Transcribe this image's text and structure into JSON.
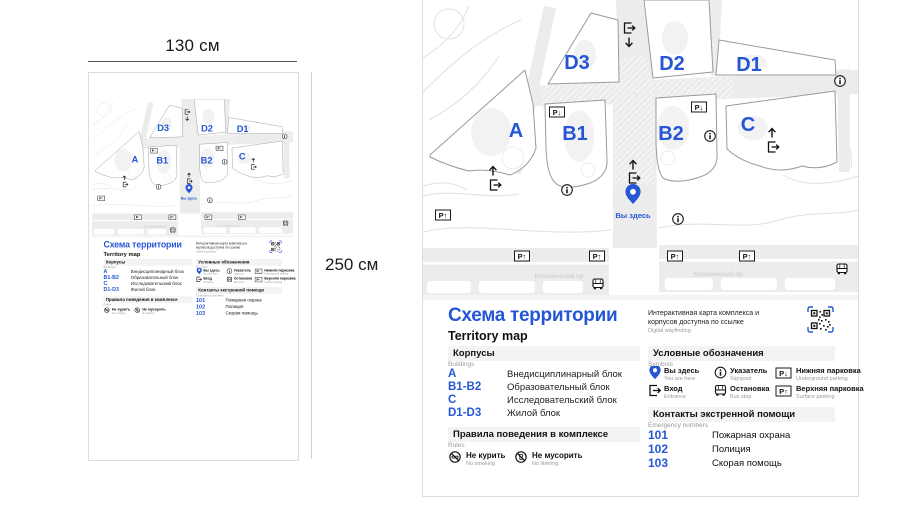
{
  "dimensions": {
    "width_label": "130 см",
    "height_label": "250 см"
  },
  "sign": {
    "title_ru": "Схема территории",
    "title_en": "Territory map",
    "qr_note_ru": "Интерактивная карта комплекса и корпусов доступна по ссылке",
    "qr_note_en": "Digital wayfinding",
    "map": {
      "buildings": {
        "a": "A",
        "b1": "B1",
        "b2": "B2",
        "c": "C",
        "d1": "D1",
        "d2": "D2",
        "d3": "D3"
      },
      "you_are_here": "Вы здесь",
      "street_name": "Коломенский пр.",
      "parking_down_label": "P↓",
      "parking_up_label": "P↑"
    },
    "sections": {
      "buildings": {
        "ru": "Корпусы",
        "en": "Buildings",
        "items": [
          {
            "code": "A",
            "name": "Внедисциплинарный блок"
          },
          {
            "code": "B1-B2",
            "name": "Образовательный блок"
          },
          {
            "code": "C",
            "name": "Исследовательский блок"
          },
          {
            "code": "D1-D3",
            "name": "Жилой блок"
          }
        ]
      },
      "rules": {
        "ru": "Правила поведения в комплексе",
        "en": "Rules",
        "items": [
          {
            "ru": "Не курить",
            "en": "No smoking"
          },
          {
            "ru": "Не мусорить",
            "en": "No littering"
          }
        ]
      },
      "symbols": {
        "ru": "Условные обозначения",
        "en": "Symbols",
        "items": [
          {
            "ru": "Вы здесь",
            "en": "You are here"
          },
          {
            "ru": "Вход",
            "en": "Entrance"
          },
          {
            "ru": "Указатель",
            "en": "Signpost"
          },
          {
            "ru": "Остановка",
            "en": "Bus stop"
          },
          {
            "ru": "Нижняя парковка",
            "en": "Underground parking"
          },
          {
            "ru": "Верхняя парковка",
            "en": "Surface parking"
          }
        ]
      },
      "emergency": {
        "ru": "Контакты экстренной помощи",
        "en": "Emergency numbers",
        "items": [
          {
            "number": "101",
            "name": "Пожарная охрана"
          },
          {
            "number": "102",
            "name": "Полиция"
          },
          {
            "number": "103",
            "name": "Скорая помощь"
          }
        ]
      }
    },
    "colors": {
      "accent": "#2456d6",
      "road": "#ececec",
      "band": "#f3f3f3"
    }
  }
}
